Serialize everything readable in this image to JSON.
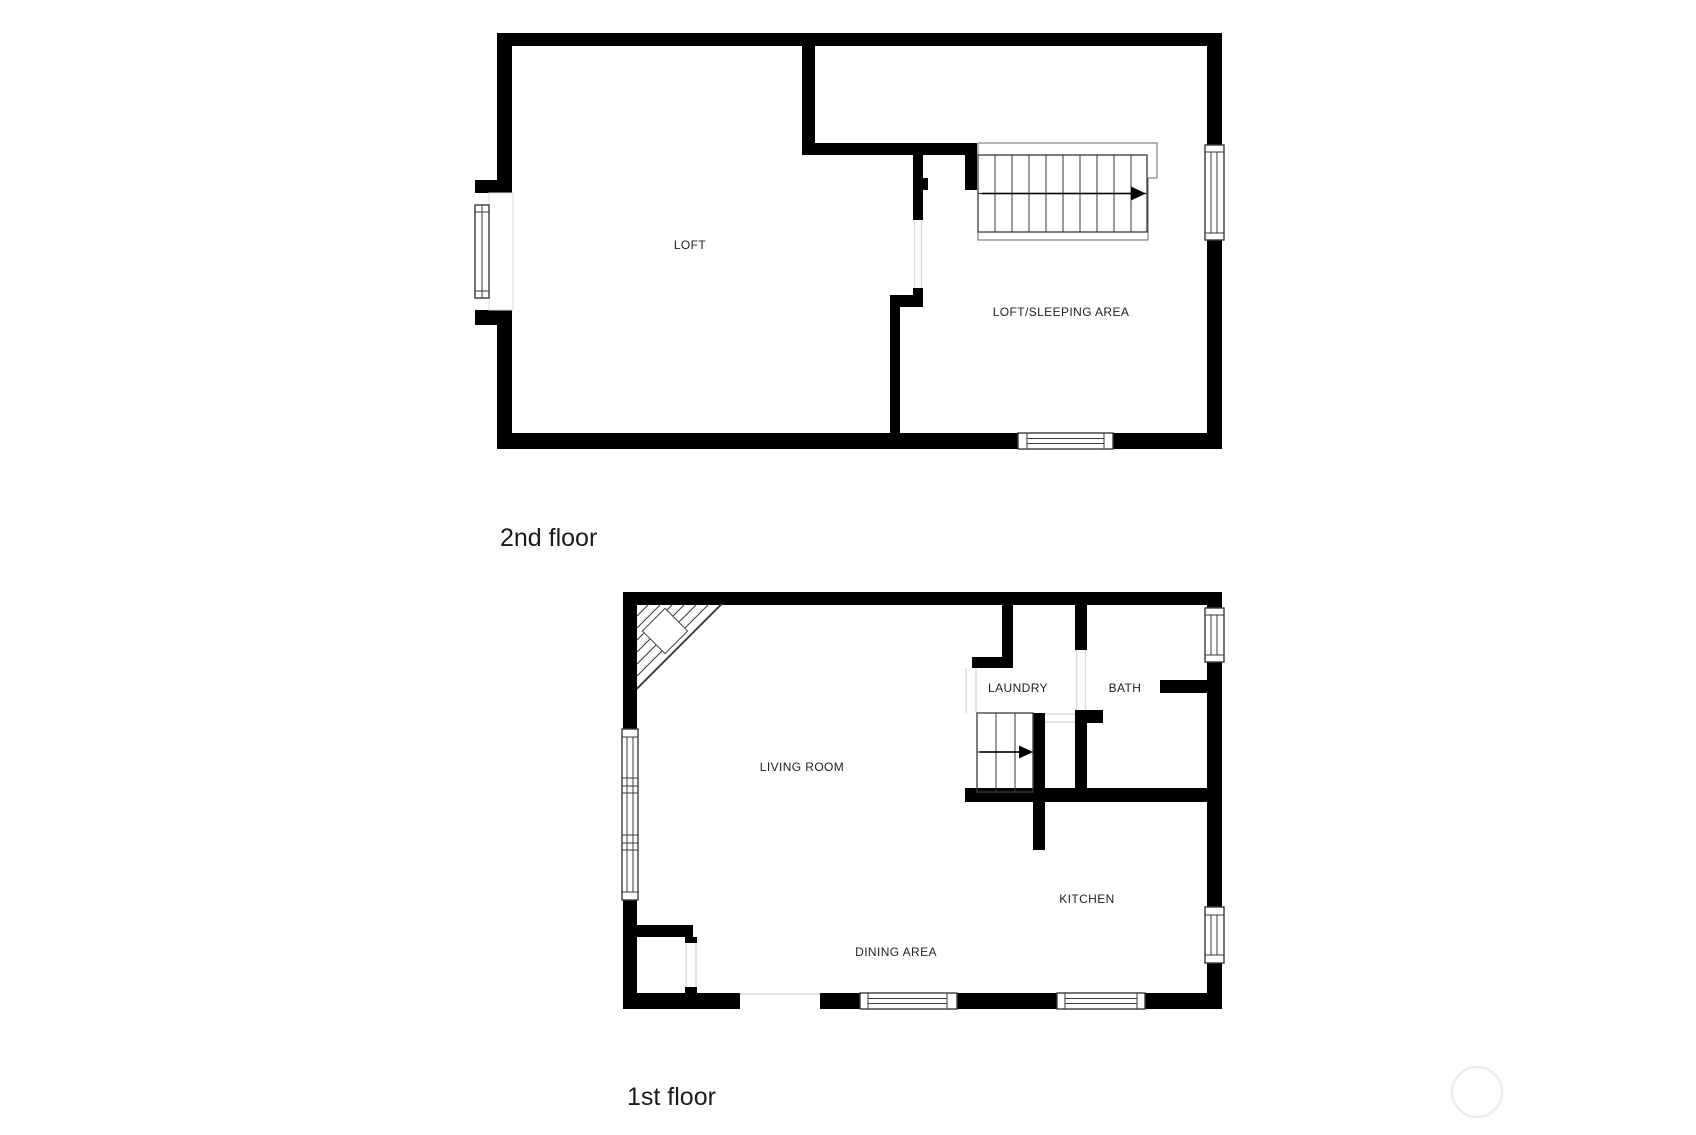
{
  "document": {
    "type": "floor-plan",
    "floors": [
      {
        "title": "2nd floor",
        "rooms": [
          {
            "label": "LOFT"
          },
          {
            "label": "LOFT/SLEEPING AREA"
          }
        ]
      },
      {
        "title": "1st floor",
        "rooms": [
          {
            "label": "LIVING ROOM"
          },
          {
            "label": "LAUNDRY"
          },
          {
            "label": "BATH"
          },
          {
            "label": "KITCHEN"
          },
          {
            "label": "DINING AREA"
          }
        ]
      }
    ]
  },
  "colors": {
    "background": "#ffffff",
    "wall": "#000000",
    "thin_line": "#3a3a3a",
    "door_line": "#d8d8d8",
    "label": "#222222",
    "title": "#1c1c1c",
    "watermark": "#ededed"
  }
}
